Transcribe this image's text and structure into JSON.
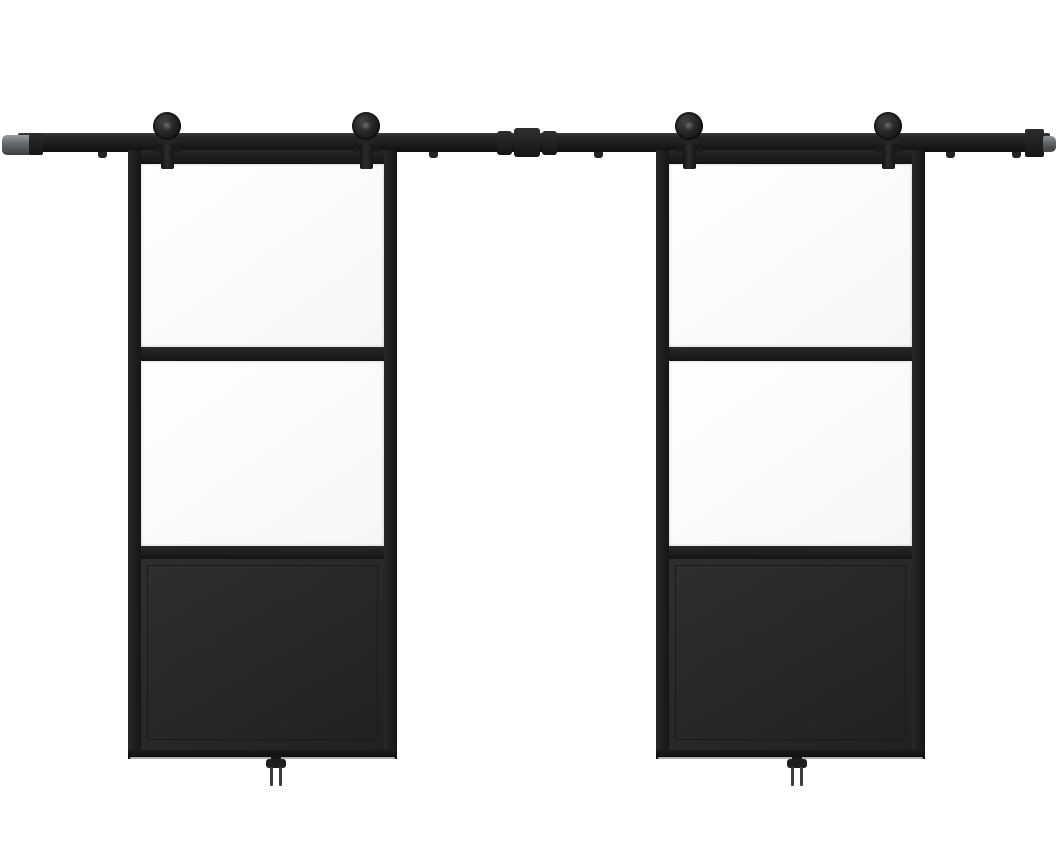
{
  "scene": {
    "subject": "Double sliding barn doors with black steel frames, two clear glass panels and a solid lower panel per door, hung on a top-mount black sliding rail with exposed rollers and floor guides",
    "width": 1059,
    "height": 855,
    "background": "#ffffff"
  },
  "colors": {
    "background_white": "#ffffff",
    "rail_dark": "#1e1e1e",
    "frame_dark": "#1c1c1c",
    "panel_dark": "#282829",
    "panel_seam": "#1a1a1b",
    "hardware_gray": "#77797b",
    "glass_white": "#fdfdfd",
    "floor_highlight": "#cfcfcf"
  },
  "rail": {
    "x": 18,
    "y": 133,
    "width": 1032,
    "height": 19,
    "left_cap": {
      "x": 2,
      "y": 135,
      "width": 29,
      "height": 20
    },
    "left_collar": {
      "x": 29,
      "y": 133,
      "width": 14,
      "height": 22
    },
    "right_collar": {
      "x": 1025,
      "y": 129,
      "width": 19,
      "height": 28
    },
    "right_cap": {
      "x": 1043,
      "y": 136,
      "width": 13,
      "height": 16
    },
    "connector_blocks": [
      {
        "x": 497,
        "y": 131,
        "width": 15,
        "height": 24
      },
      {
        "x": 514,
        "y": 128,
        "width": 26,
        "height": 29
      },
      {
        "x": 542,
        "y": 131,
        "width": 15,
        "height": 24
      }
    ],
    "mount_bolts_x": [
      102,
      267,
      433,
      598,
      763,
      950,
      1016
    ]
  },
  "rollers": {
    "count": 4,
    "wheel_radius": 14,
    "wheel_center_y": 126,
    "strap_top_y": 117,
    "strap_bottom_y": 169,
    "positions_x": [
      167,
      366,
      689,
      888
    ]
  },
  "doors": [
    {
      "id": "left-door",
      "x": 128,
      "width": 269
    },
    {
      "id": "right-door",
      "x": 656,
      "width": 269
    }
  ],
  "door_geometry": {
    "top_y": 150,
    "bottom_y": 759,
    "side_frame_width": 13,
    "top_frame_height": 14,
    "glass_top": {
      "rel_y": 14,
      "height": 183
    },
    "mid_rail_1": {
      "rel_y": 197,
      "height": 14
    },
    "glass_middle": {
      "rel_y": 211,
      "height": 185
    },
    "mid_rail_2": {
      "rel_y": 396,
      "height": 13
    },
    "bottom_panel": {
      "rel_y": 409,
      "height": 191
    },
    "bottom_frame": {
      "rel_y": 600,
      "height": 9
    }
  },
  "floor_guides": {
    "centers_x": [
      276,
      797
    ],
    "top_y": 753
  }
}
